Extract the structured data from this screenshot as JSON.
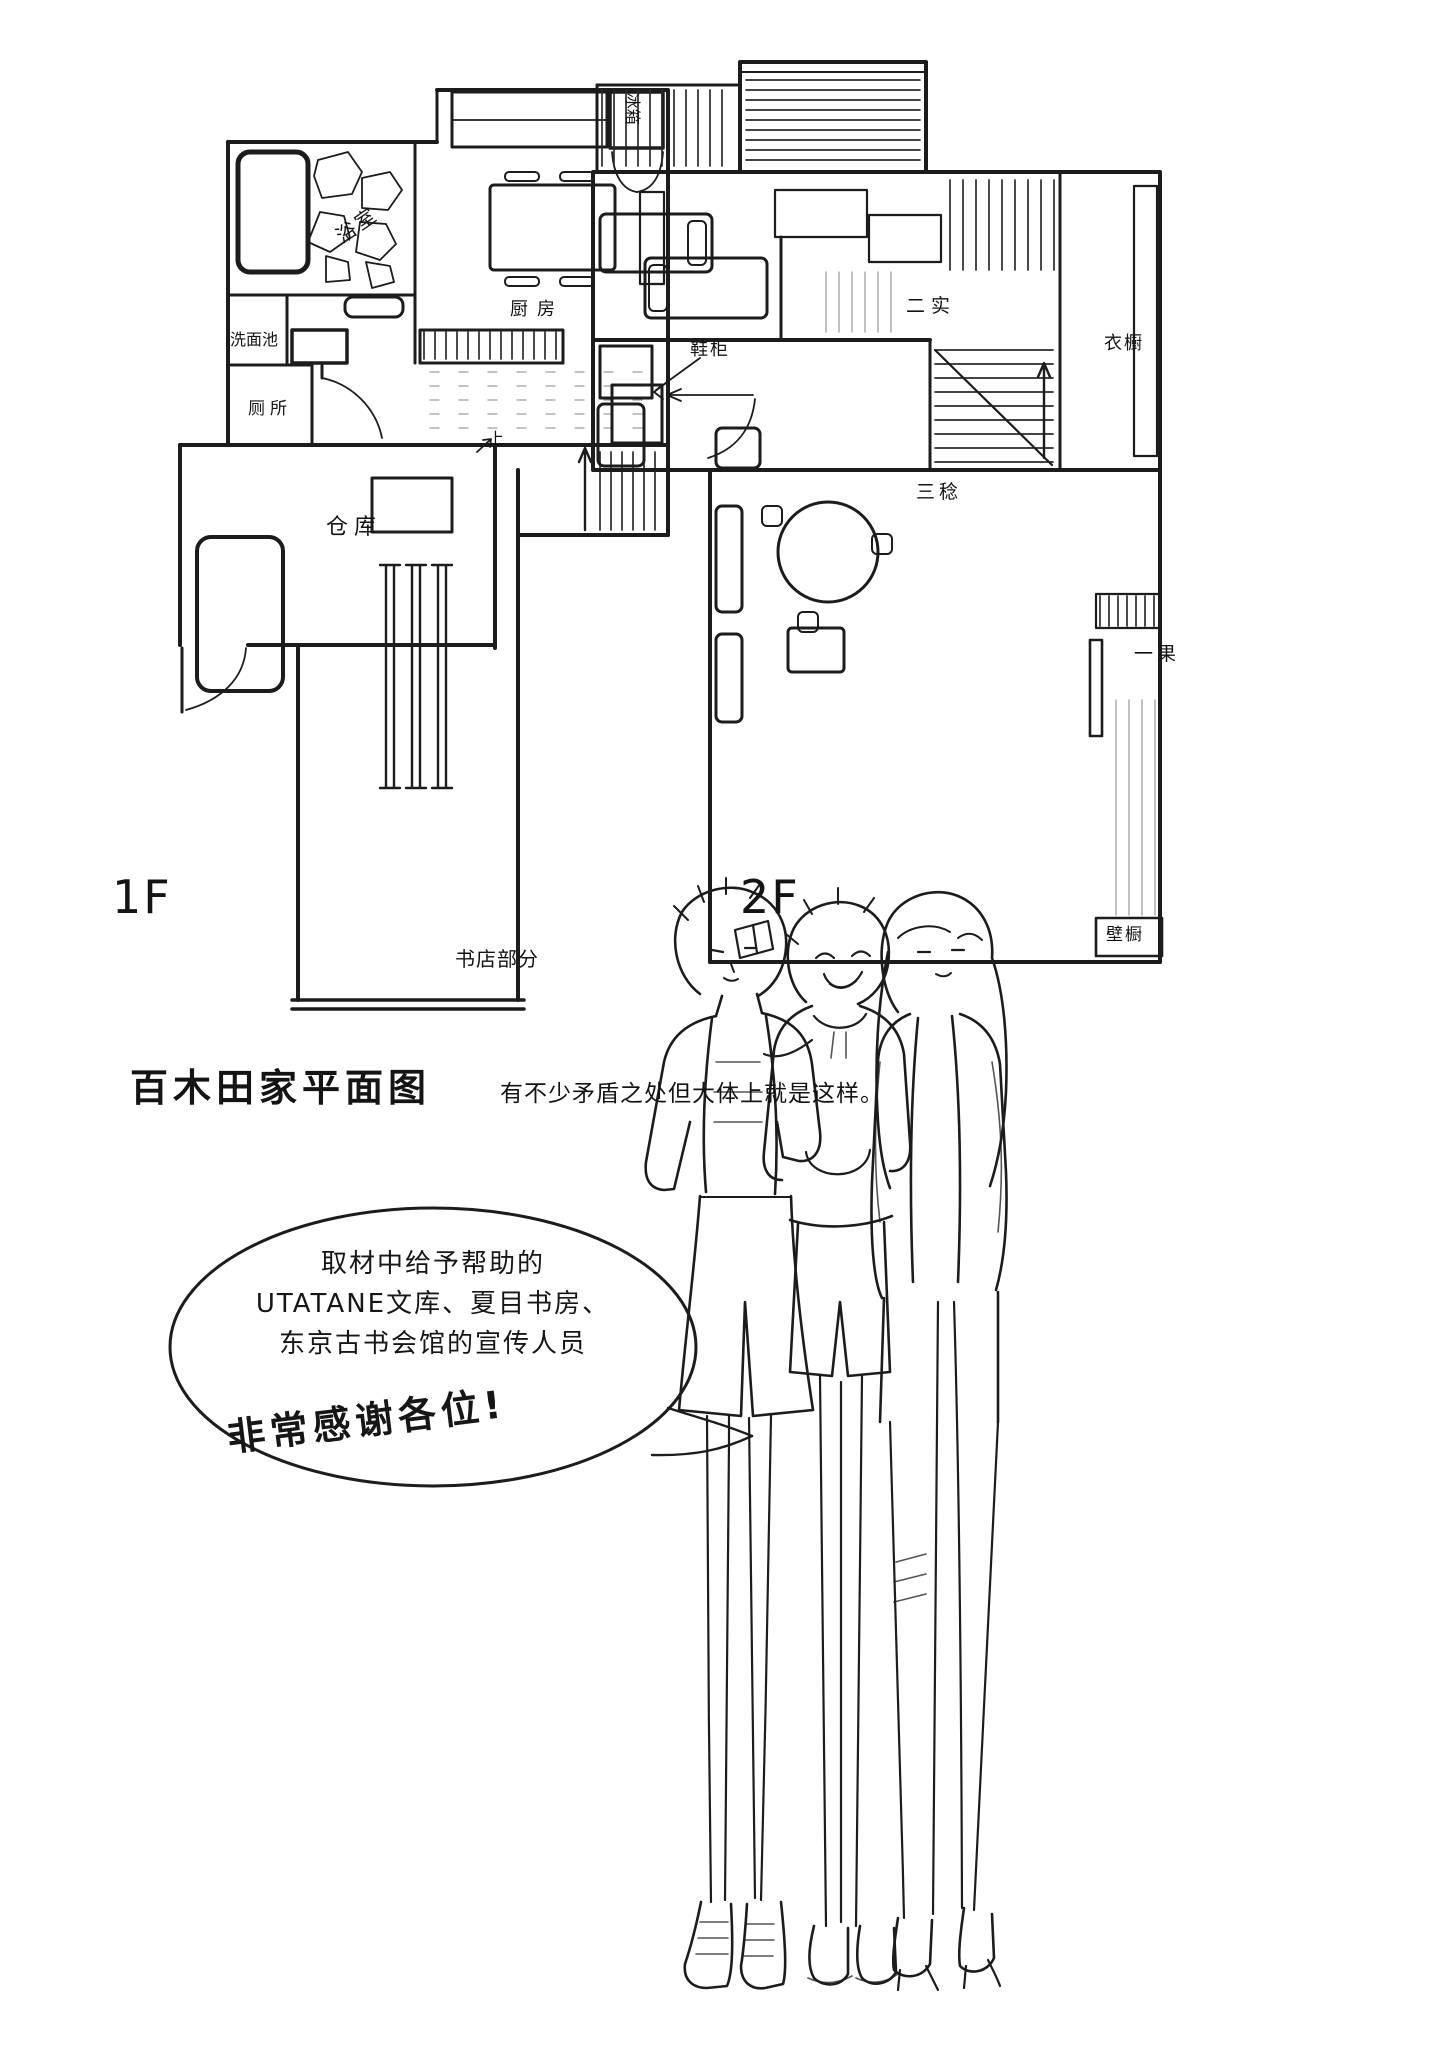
{
  "page": {
    "background": "#ffffff",
    "ink": "#1c1c1c"
  },
  "floor1": {
    "floor_label": "1F",
    "labels": {
      "fridge": "冰箱",
      "bathroom": "浴室",
      "kitchen": "厨房",
      "washbasin": "洗面池",
      "toilet": "厕所",
      "shoe_cabinet": "鞋柜",
      "storage": "仓库",
      "stairs_up": "上",
      "bookstore": "书店部分"
    }
  },
  "floor2": {
    "floor_label": "2F",
    "labels": {
      "futami": "二实",
      "wardrobe": "衣橱",
      "mitsuru": "三稔",
      "ichika": "一果",
      "closet": "壁橱"
    }
  },
  "caption": {
    "title": "百木田家平面图",
    "note": "有不少矛盾之处但大体上就是这样。"
  },
  "bubble": {
    "line1": "取材中给予帮助的",
    "line2": "UTATANE文库、夏目书房、",
    "line3": "东京古书会馆的宣传人员",
    "thanks": "非常感谢各位!"
  }
}
